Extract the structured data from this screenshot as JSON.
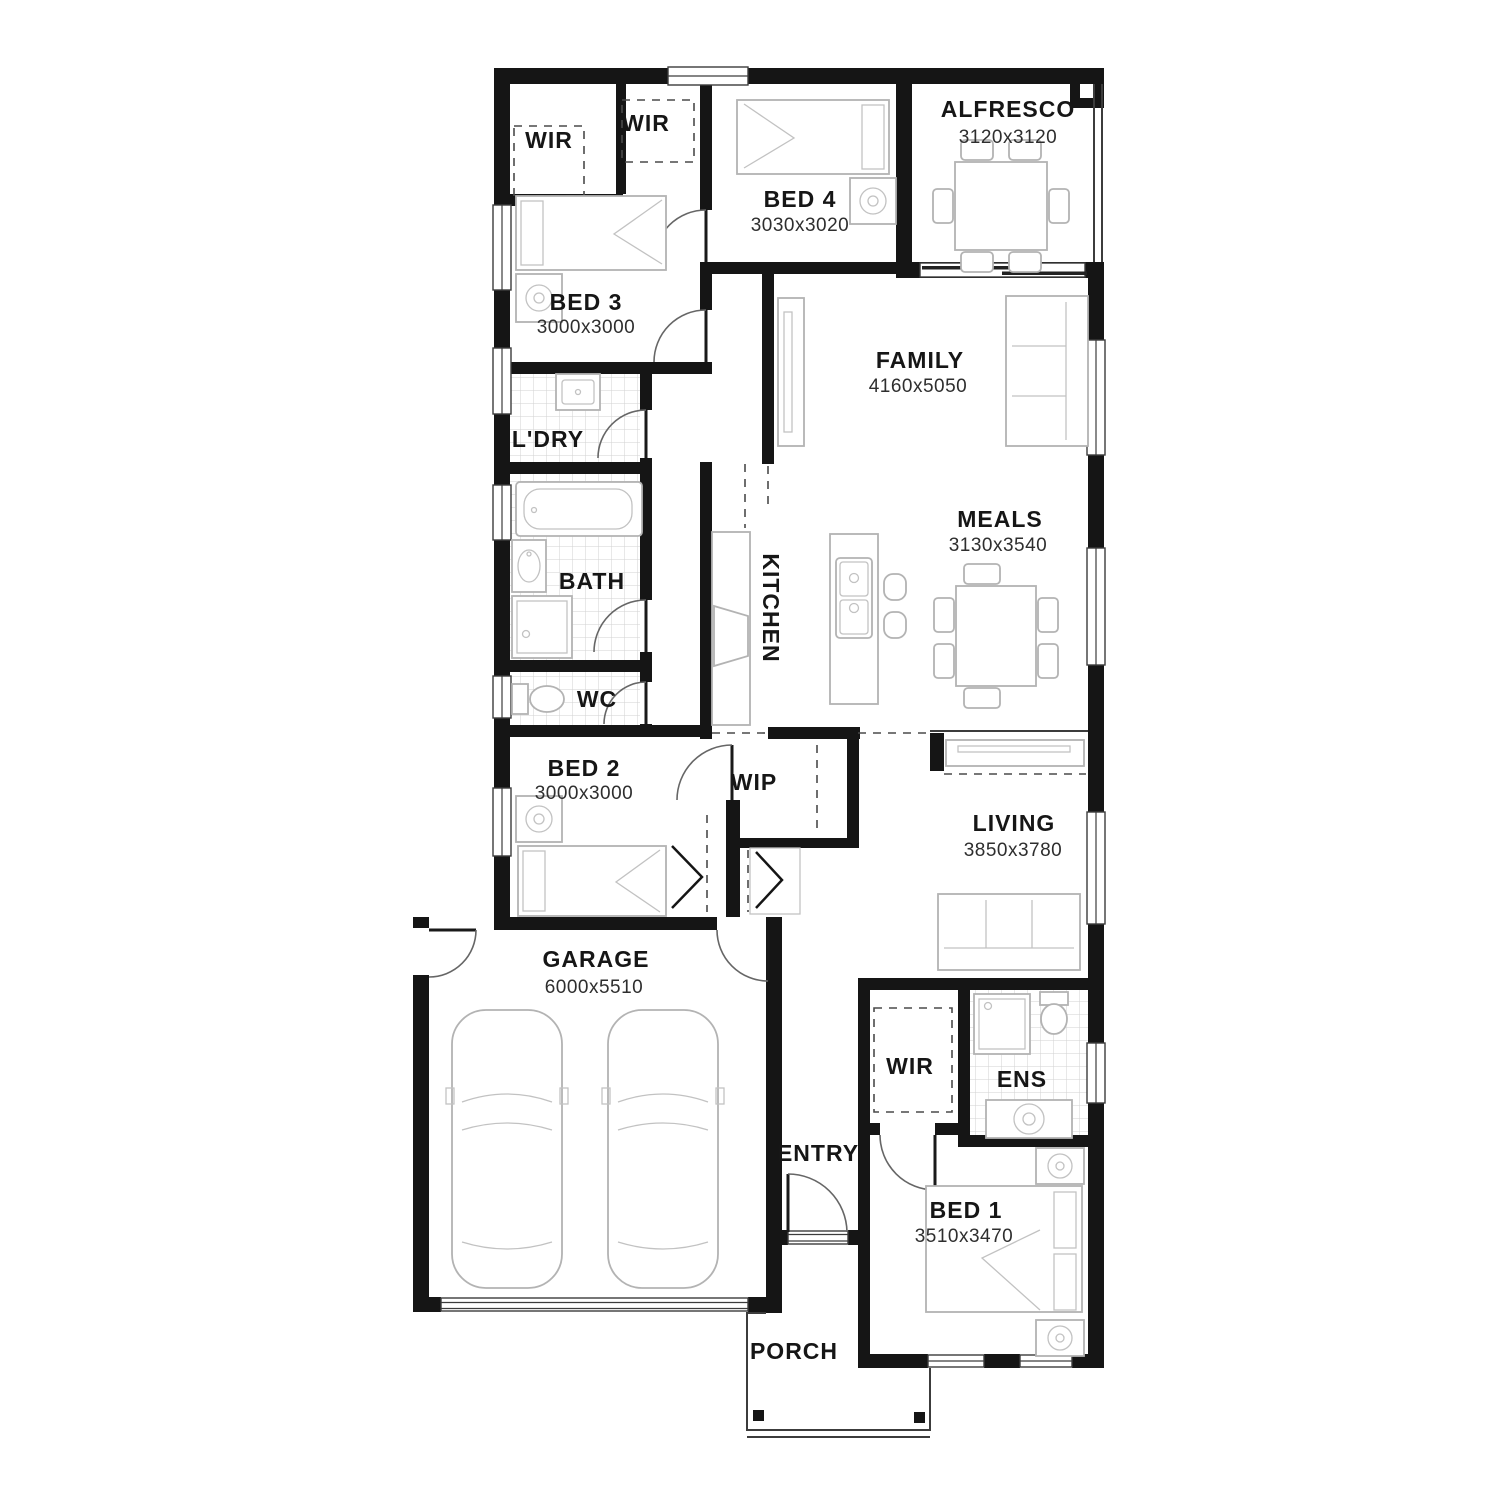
{
  "plan": {
    "type": "house-floor-plan",
    "rooms": {
      "wir_left": {
        "label": "WIR"
      },
      "wir_top": {
        "label": "WIR"
      },
      "bed4": {
        "label": "BED 4",
        "dims": "3030x3020"
      },
      "alfresco": {
        "label": "ALFRESCO",
        "dims": "3120x3120"
      },
      "bed3": {
        "label": "BED 3",
        "dims": "3000x3000"
      },
      "family": {
        "label": "FAMILY",
        "dims": "4160x5050"
      },
      "laundry": {
        "label": "L'DRY"
      },
      "bath": {
        "label": "BATH"
      },
      "kitchen": {
        "label": "KITCHEN"
      },
      "meals": {
        "label": "MEALS",
        "dims": "3130x3540"
      },
      "wc": {
        "label": "WC"
      },
      "bed2": {
        "label": "BED 2",
        "dims": "3000x3000"
      },
      "wip": {
        "label": "WIP"
      },
      "living": {
        "label": "LIVING",
        "dims": "3850x3780"
      },
      "garage": {
        "label": "GARAGE",
        "dims": "6000x5510"
      },
      "wir_bed1": {
        "label": "WIR"
      },
      "ens": {
        "label": "ENS"
      },
      "entry": {
        "label": "ENTRY"
      },
      "bed1": {
        "label": "BED 1",
        "dims": "3510x3470"
      },
      "porch": {
        "label": "PORCH"
      }
    },
    "colors": {
      "wall": "#151515",
      "furniture_outline": "#b3b3b3",
      "tile_grid": "#d2d2d2",
      "label_text": "#161616",
      "dimension_text": "#2e2e2e",
      "background": "#ffffff"
    }
  }
}
